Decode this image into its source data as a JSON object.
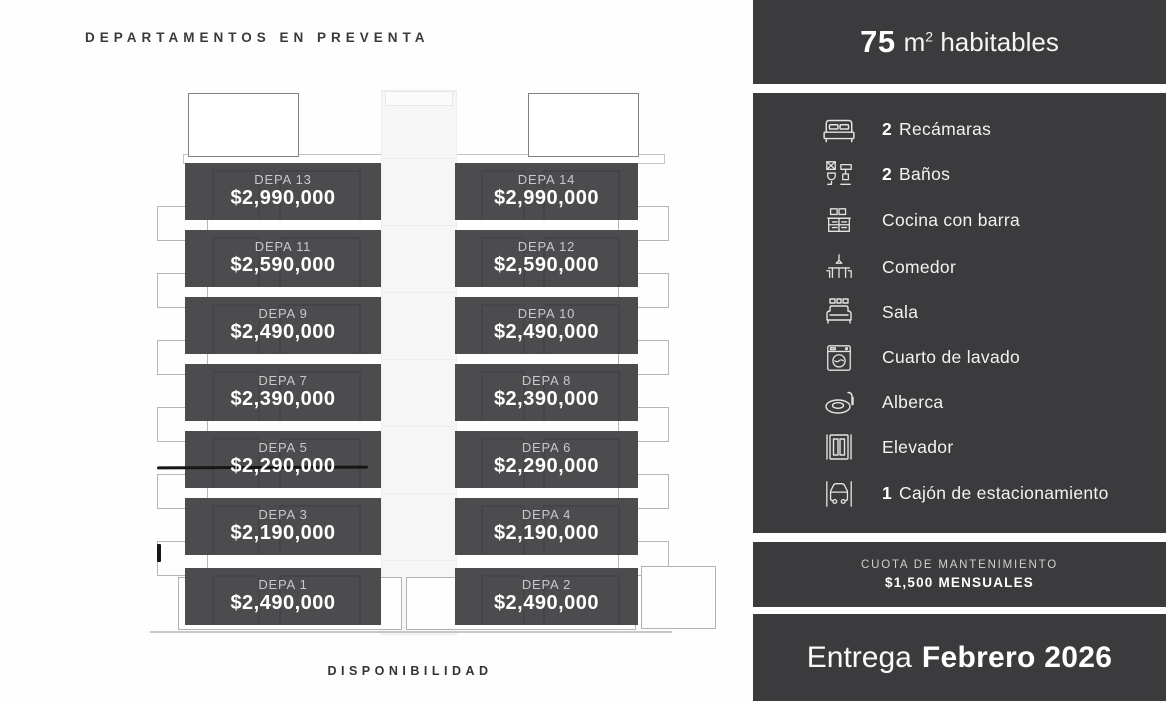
{
  "left_panel": {
    "title": "DEPARTAMENTOS EN PREVENTA",
    "footer": "DISPONIBILIDAD"
  },
  "building": {
    "floors": [
      {
        "left": {
          "name": "DEPA 13",
          "price": "$2,990,000"
        },
        "right": {
          "name": "DEPA 14",
          "price": "$2,990,000"
        }
      },
      {
        "left": {
          "name": "DEPA 11",
          "price": "$2,590,000"
        },
        "right": {
          "name": "DEPA 12",
          "price": "$2,590,000"
        }
      },
      {
        "left": {
          "name": "DEPA 9",
          "price": "$2,490,000"
        },
        "right": {
          "name": "DEPA 10",
          "price": "$2,490,000"
        }
      },
      {
        "left": {
          "name": "DEPA 7",
          "price": "$2,390,000"
        },
        "right": {
          "name": "DEPA 8",
          "price": "$2,390,000"
        }
      },
      {
        "left": {
          "name": "DEPA 5",
          "price": "$2,290,000"
        },
        "right": {
          "name": "DEPA 6",
          "price": "$2,290,000"
        }
      },
      {
        "left": {
          "name": "DEPA 3",
          "price": "$2,190,000"
        },
        "right": {
          "name": "DEPA 4",
          "price": "$2,190,000"
        }
      },
      {
        "left": {
          "name": "DEPA 1",
          "price": "$2,490,000"
        },
        "right": {
          "name": "DEPA 2",
          "price": "$2,490,000"
        }
      }
    ],
    "annotations": [
      "strike-through on DEPA 5",
      "tick mark near DEPA 3"
    ]
  },
  "sidebar": {
    "header": {
      "area_value": "75",
      "area_unit": "m",
      "area_exp": "2",
      "area_rest": "habitables"
    },
    "amenities": [
      {
        "icon": "bed-icon",
        "qty": "2",
        "label": "Recámaras"
      },
      {
        "icon": "bathroom-icon",
        "qty": "2",
        "label": "Baños"
      },
      {
        "icon": "kitchen-icon",
        "qty": "",
        "label": "Cocina con barra"
      },
      {
        "icon": "dining-icon",
        "qty": "",
        "label": "Comedor"
      },
      {
        "icon": "sofa-icon",
        "qty": "",
        "label": "Sala"
      },
      {
        "icon": "laundry-icon",
        "qty": "",
        "label": "Cuarto de lavado"
      },
      {
        "icon": "pool-icon",
        "qty": "",
        "label": "Alberca"
      },
      {
        "icon": "elevator-icon",
        "qty": "",
        "label": "Elevador"
      },
      {
        "icon": "parking-icon",
        "qty": "1",
        "label": "Cajón de estacionamiento"
      }
    ],
    "maintenance": {
      "line1": "CUOTA DE MANTENIMIENTO",
      "line2": "$1,500 MENSUALES"
    },
    "delivery": {
      "prefix": "Entrega",
      "value": "Febrero 2026"
    }
  },
  "colors": {
    "sidebar_bg": "#3b3a3c",
    "unit_box_bg": "#4c4b4d",
    "unit_name": "#c9c8ca",
    "text_white": "#ffffff",
    "annotation_black": "#161616"
  }
}
